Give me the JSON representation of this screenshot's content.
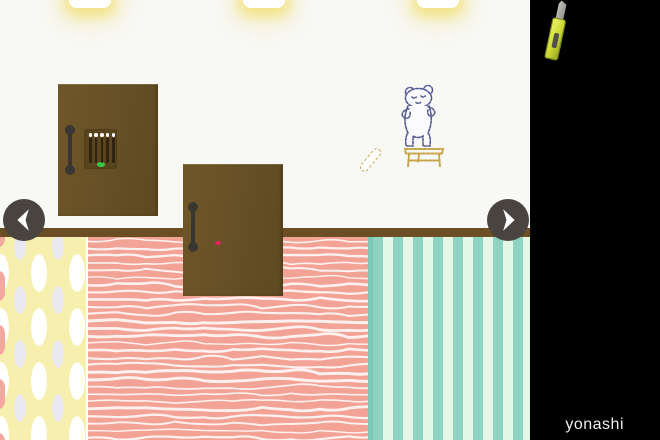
{
  "game": {
    "credit": {
      "text": "yonashi"
    },
    "navigation": {
      "left": {
        "name": "turn-left"
      },
      "right": {
        "name": "turn-right"
      }
    },
    "scene": {
      "description": "escape-room wall with two locked doors",
      "lights_count": 3,
      "doors": [
        {
          "id": "door-left",
          "lock": {
            "type": "five-lever-panel",
            "lever_count": 5,
            "indicator": "green"
          }
        },
        {
          "id": "door-right",
          "lock": {
            "type": "keypad",
            "rows": 3,
            "cols": 3,
            "indicator": "red"
          }
        }
      ],
      "drawings": [
        {
          "name": "bear-on-stool-sketch"
        },
        {
          "name": "stick-sketch"
        }
      ],
      "floor_sections": [
        {
          "name": "dotted-yellow"
        },
        {
          "name": "wavy-pink"
        },
        {
          "name": "striped-teal"
        }
      ]
    },
    "inventory": {
      "items": [
        {
          "name": "cutter",
          "slot": 1
        }
      ]
    }
  },
  "theme": {
    "wall": "#f8f8f5",
    "baseboard": "#6b4e23",
    "door": "#6a5226",
    "handle": "#3a3733",
    "green_dot": "#2ecc40",
    "red_dot": "#e0245e",
    "keypad_cell": "#f1eee6",
    "nav_button": "#494440",
    "floor_yellow": "#f6efae",
    "floor_pink": "#f2a396",
    "floor_teal_a": "#8ed2c2",
    "floor_teal_b": "#e4f6e5",
    "sidebar": "#000000",
    "cutter_body": "#ccd833",
    "ink_blue": "#565b96",
    "ink_tan": "#c9a44a",
    "credit_text": "#eeeeee"
  }
}
